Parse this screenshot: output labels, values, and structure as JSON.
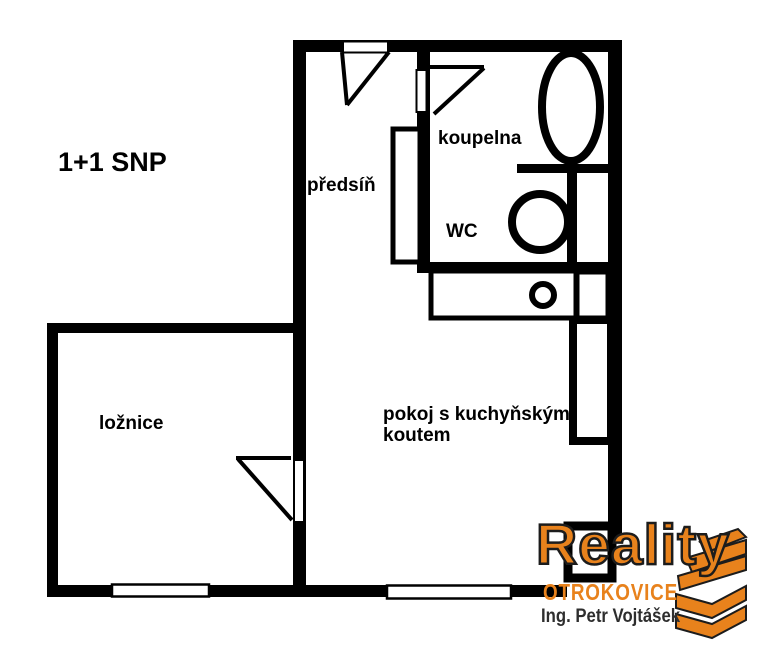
{
  "title": "1+1 SNP",
  "rooms": {
    "predsin": "předsíň",
    "koupelna": "koupelna",
    "wc": "WC",
    "loznice": "ložnice",
    "pokoj": "pokoj s kuchyňským koutem"
  },
  "fixtures": {
    "bathtub": "bathtub-icon",
    "toilet": "toilet-icon",
    "sink": "sink-icon",
    "closet": "closet-rectangle",
    "counter": "kitchen-counter",
    "column": "corner-column"
  },
  "logo": {
    "brand": "Reality",
    "city": "OTROKOVICE",
    "agent": "Ing. Petr Vojtášek"
  },
  "colors": {
    "wall": "#000000",
    "background": "#ffffff",
    "logo_orange": "#e8821c",
    "logo_outline": "#1c1c1c",
    "agent_text": "#2e2e2e"
  }
}
